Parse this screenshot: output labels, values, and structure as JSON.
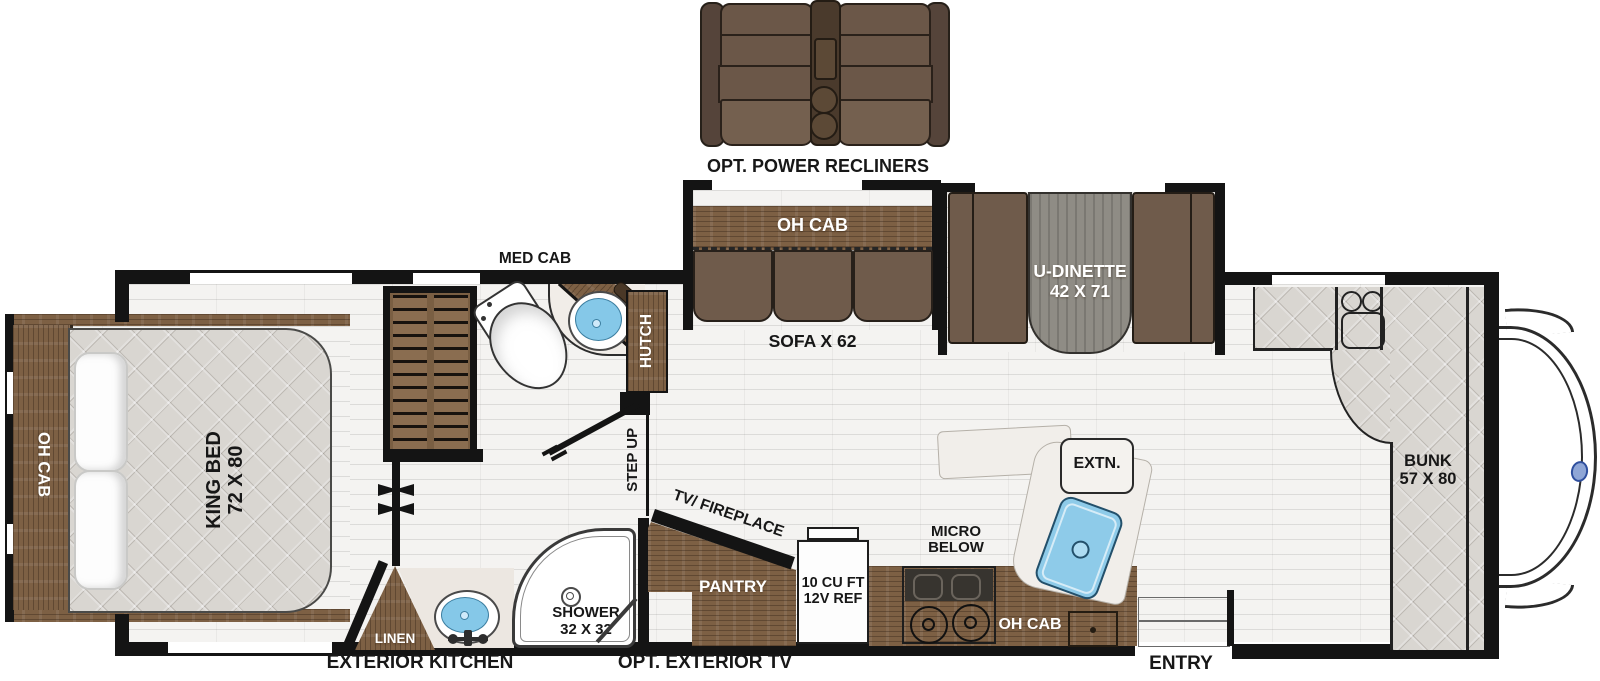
{
  "diagram": {
    "type": "rv-motorhome-floorplan"
  },
  "labels": {
    "recliners": "OPT. POWER RECLINERS",
    "sofa_oh_cab": "OH CAB",
    "sofa": "SOFA X 62",
    "dinette_l1": "U-DINETTE",
    "dinette_l2": "42 X 71",
    "med_cab": "MED CAB",
    "hutch": "HUTCH",
    "step_up": "STEP UP",
    "bed_oh_cab": "OH CAB",
    "king_bed_l1": "KING BED",
    "king_bed_l2": "72 X 80",
    "linen": "LINEN",
    "shower_l1": "SHOWER",
    "shower_l2": "32 X 32",
    "tv_fireplace": "TV/ FIREPLACE",
    "pantry": "PANTRY",
    "fridge_l1": "10 CU FT",
    "fridge_l2": "12V REF",
    "micro_l1": "MICRO",
    "micro_l2": "BELOW",
    "extn": "EXTN.",
    "kitchen_oh_cab": "OH CAB",
    "bunk_l1": "BUNK",
    "bunk_l2": "57 X 80",
    "exterior_kitchen": "EXTERIOR KITCHEN",
    "opt_exterior_tv": "OPT. EXTERIOR TV",
    "entry": "ENTRY"
  },
  "colors": {
    "wall": "#141414",
    "wood_cabinet": "#7d6044",
    "upholstery_brown": "#6f5b4b",
    "mattress_gray": "#d9d6d1",
    "sink_blue": "#8ecbe9",
    "floor": "#f4f3f1",
    "table_gray": "#8f8c85"
  }
}
